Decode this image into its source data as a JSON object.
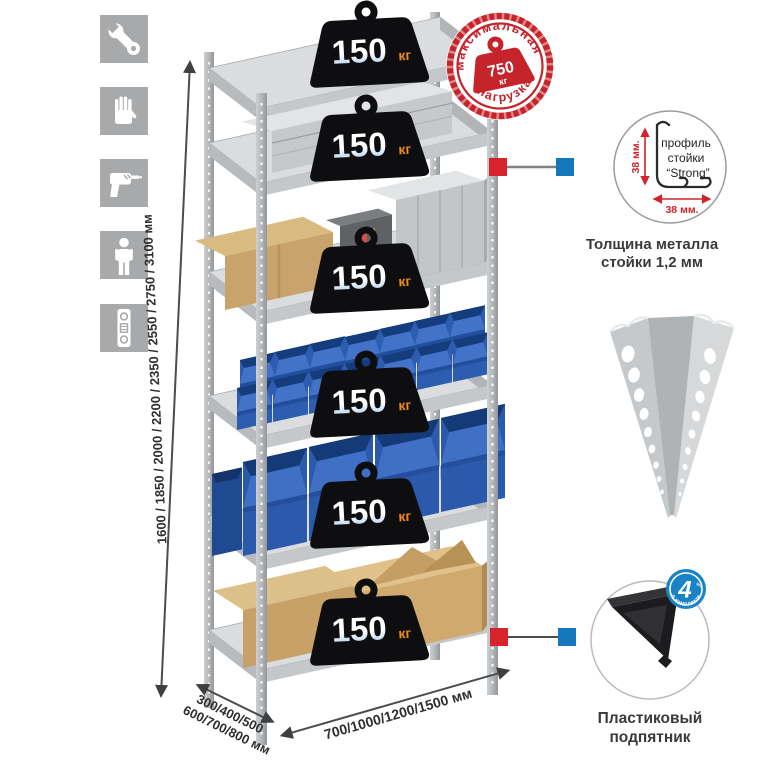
{
  "colors": {
    "stamp_red": "#c5242b",
    "connector_red": "#d7242c",
    "connector_blue": "#1478bd",
    "kit_badge_blue": "#1983c5",
    "bin_blue": "#2d5db0",
    "weight_black": "#0e0e10",
    "kg_orange": "#f2891c",
    "icon_gray": "#a7a9ab"
  },
  "left_icons": [
    {
      "name": "wrench"
    },
    {
      "name": "gloves"
    },
    {
      "name": "drill"
    },
    {
      "name": "person"
    },
    {
      "name": "level"
    }
  ],
  "dimensions": {
    "height_label": "1600 / 1850 / 2000 / 2200 / 2350 / 2550 / 2750 / 3100 мм",
    "depth_line1": "300/400/500",
    "depth_line2": "600/700/800 мм",
    "width_label": "700/1000/1200/1500 мм"
  },
  "max_load_stamp": {
    "arc_top": "максимальная",
    "arc_bottom": "нагрузка",
    "value": "750",
    "unit": "кг"
  },
  "shelves": [
    {
      "load": "150",
      "unit": "кг"
    },
    {
      "load": "150",
      "unit": "кг"
    },
    {
      "load": "150",
      "unit": "кг"
    },
    {
      "load": "150",
      "unit": "кг"
    },
    {
      "load": "150",
      "unit": "кг"
    },
    {
      "load": "150",
      "unit": "кг"
    }
  ],
  "profile_detail": {
    "line1": "профиль",
    "line2": "стойки",
    "line3": "“Strong”",
    "dim_vertical": "38 мм.",
    "dim_horizontal": "38 мм.",
    "caption_line1": "Толщина металла",
    "caption_line2": "стойки 1,2 мм"
  },
  "foot_detail": {
    "badge_value": "4",
    "badge_arc": "в комплекте",
    "badge_note": "шт.",
    "caption_line1": "Пластиковый",
    "caption_line2": "подпятник"
  }
}
